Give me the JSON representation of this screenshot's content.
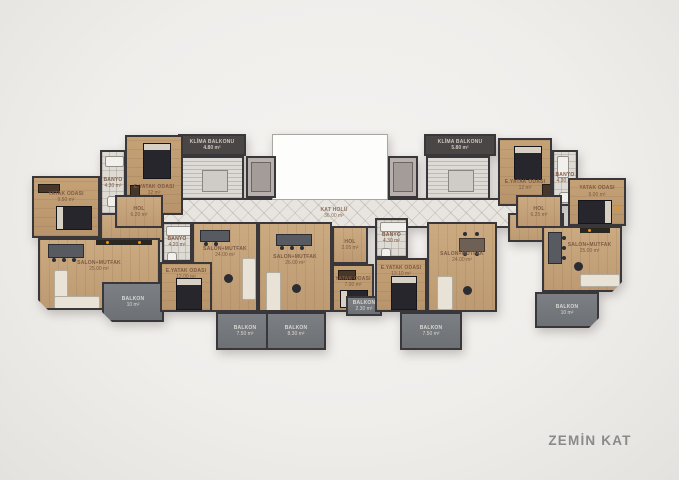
{
  "title": "ZEMİN KAT",
  "colors": {
    "background": "#f1efec",
    "wall": "#3a373b",
    "wood_floor": "#c6a47b",
    "hall_tile": "#e8e5e0",
    "balcony": "#75797d",
    "dark_header": "#4a4646",
    "accent_orange": "#e6921e",
    "title_text": "#8a8a8a"
  },
  "rooms": [
    {
      "label": "YATAK ODASI",
      "area": "9.50 m²"
    },
    {
      "label": "E.YATAK ODASI",
      "area": "12 m²"
    },
    {
      "label": "BANYO",
      "area": "4.30 m²"
    },
    {
      "label": "HOL",
      "area": "6.20 m²"
    },
    {
      "label": "SALON+MUTFAK",
      "area": "25.00 m²"
    },
    {
      "label": "BALKON",
      "area": "10 m²"
    },
    {
      "label": "BANYO",
      "area": "4.20 m²"
    },
    {
      "label": "E.YATAK ODASI",
      "area": "12.00 m²"
    },
    {
      "label": "SALON+MUTFAK",
      "area": "24.00 m²"
    },
    {
      "label": "BALKON",
      "area": "7.50 m²"
    },
    {
      "label": "SALON+MUTFAK",
      "area": "26.00 m²"
    },
    {
      "label": "HOL",
      "area": "2.05 m²"
    },
    {
      "label": "YATAK ODASI",
      "area": "7.00 m²"
    },
    {
      "label": "BALKON",
      "area": "8.30 m²"
    },
    {
      "label": "BALKON",
      "area": "2.30 m²"
    },
    {
      "label": "BANYO",
      "area": "4.30 m²"
    },
    {
      "label": "E.YATAK ODASI",
      "area": "13.10 m²"
    },
    {
      "label": "SALON+MUTFAK",
      "area": "24.00 m²"
    },
    {
      "label": "BALKON",
      "area": "7.50 m²"
    },
    {
      "label": "E.YATAK ODASI",
      "area": "12 m²"
    },
    {
      "label": "BANYO",
      "area": "4.30 m²"
    },
    {
      "label": "YATAK ODASI",
      "area": "9.00 m²"
    },
    {
      "label": "HOL",
      "area": "6.25 m²"
    },
    {
      "label": "SALON+MUTFAK",
      "area": "25.00 m²"
    },
    {
      "label": "BALKON",
      "area": "10 m²"
    },
    {
      "label": "KAT HOLÜ",
      "area": "36.00 m²"
    },
    {
      "label": "KLİMA BALKONU",
      "area": "4.80 m²"
    },
    {
      "label": "KLİMA BALKONU",
      "area": "5.80 m²"
    }
  ]
}
